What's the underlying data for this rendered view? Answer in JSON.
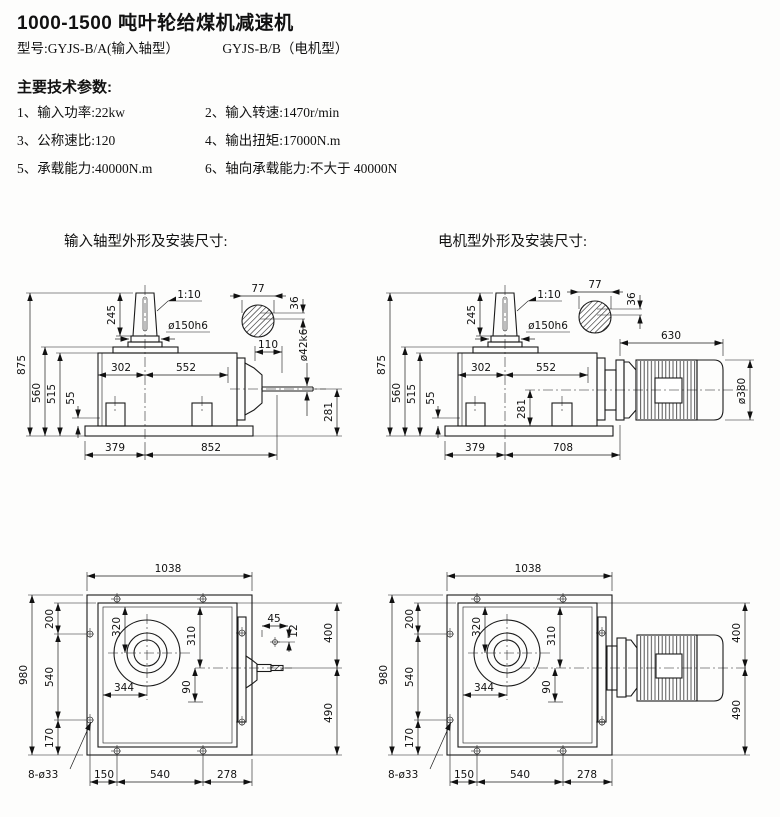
{
  "header": {
    "title": "1000-1500 吨叶轮给煤机减速机",
    "model_a": "型号:GYJS-B/A(输入轴型）",
    "model_b": "GYJS-B/B（电机型）",
    "params_heading": "主要技术参数:",
    "params": {
      "p1": "1、输入功率:22kw",
      "p2": "2、输入转速:1470r/min",
      "p3": "3、公称速比:120",
      "p4": "4、输出扭矩:17000N.m",
      "p5": "5、承载能力:40000N.m",
      "p6": "6、轴向承载能力:不大于 40000N"
    }
  },
  "captions": {
    "side_a": "输入轴型外形及安装尺寸:",
    "side_b": "电机型外形及安装尺寸:"
  },
  "side_a": {
    "overall_h": "875",
    "plate_h": "560",
    "body_h": "515",
    "foot_h": "55",
    "cone_h": "245",
    "taper": "1:10",
    "cone_dia": "ø150h6",
    "key_w": "77",
    "key_h": "36",
    "w302": "302",
    "w552": "552",
    "shaft_len": "110",
    "shaft_dia": "ø42k6",
    "axis_h": "281",
    "base_l": "379",
    "base_r": "852"
  },
  "side_b": {
    "overall_h": "875",
    "plate_h": "560",
    "body_h": "515",
    "foot_h": "55",
    "cone_h": "245",
    "taper": "1:10",
    "cone_dia": "ø150h6",
    "key_w": "77",
    "key_h": "36",
    "w302": "302",
    "w552": "552",
    "axis_h": "281",
    "base_l": "379",
    "base_r": "708",
    "motor_len": "630",
    "motor_dia": "ø380"
  },
  "top_a": {
    "w1038": "1038",
    "h980": "980",
    "e200": "200",
    "e540": "540",
    "e170": "170",
    "c320": "320",
    "c310": "310",
    "c344": "344",
    "c90": "90",
    "k45": "45",
    "k12": "12",
    "r400": "400",
    "r490": "490",
    "b150": "150",
    "b540": "540",
    "b278": "278",
    "holes": "8-ø33"
  },
  "top_b": {
    "w1038": "1038",
    "h980": "980",
    "e200": "200",
    "e540": "540",
    "e170": "170",
    "c320": "320",
    "c310": "310",
    "c344": "344",
    "c90": "90",
    "r400": "400",
    "r490": "490",
    "b150": "150",
    "b540": "540",
    "b278": "278",
    "holes": "8-ø33"
  }
}
